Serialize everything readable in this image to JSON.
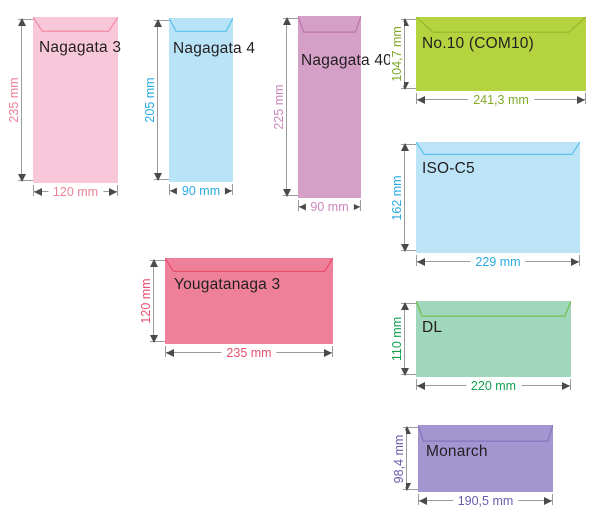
{
  "page": {
    "background": "#ffffff"
  },
  "arrow": {
    "line_color": "#9b9b9b",
    "head_color": "#4a4a4a"
  },
  "label_color": "#231f20",
  "envelopes": [
    {
      "id": "nagagata-3",
      "label": "Nagagata 3",
      "height_label": "235 mm",
      "width_label": "120 mm",
      "fill": "#f8c8da",
      "flap_line": "#f08ba4",
      "dim_color": "#ee8298",
      "orientation": "portrait"
    },
    {
      "id": "nagagata-4",
      "label": "Nagagata 4",
      "height_label": "205 mm",
      "width_label": "90 mm",
      "fill": "#b9e3f6",
      "flap_line": "#58c2ea",
      "dim_color": "#29abe2",
      "orientation": "portrait"
    },
    {
      "id": "nagagata-40",
      "label": "Nagagata 40",
      "height_label": "225 mm",
      "width_label": "90 mm",
      "fill": "#d4a0c7",
      "flap_line": "#bd72ab",
      "dim_color": "#cd86bd",
      "orientation": "portrait"
    },
    {
      "id": "no10-com10",
      "label": "No.10 (COM10)",
      "height_label": "104,7 mm",
      "width_label": "241,3 mm",
      "fill": "#b5d23f",
      "flap_line": "#96b52e",
      "dim_color": "#7fa826",
      "orientation": "landscape"
    },
    {
      "id": "iso-c5",
      "label": "ISO-C5",
      "height_label": "162 mm",
      "width_label": "229 mm",
      "fill": "#bce3f6",
      "flap_line": "#5cc3ee",
      "dim_color": "#29abe2",
      "orientation": "landscape"
    },
    {
      "id": "yougatanaga-3",
      "label": "Yougatanaga 3",
      "height_label": "120 mm",
      "width_label": "235 mm",
      "fill": "#ee8199",
      "flap_line": "#e84a68",
      "dim_color": "#e8516f",
      "orientation": "landscape"
    },
    {
      "id": "dl",
      "label": "DL",
      "height_label": "110 mm",
      "width_label": "220 mm",
      "fill": "#a0d6bb",
      "flap_line": "#6cbf47",
      "dim_color": "#14a050",
      "orientation": "landscape"
    },
    {
      "id": "monarch",
      "label": "Monarch",
      "height_label": "98,4 mm",
      "width_label": "190,5 mm",
      "fill": "#a396d0",
      "flap_line": "#8175bd",
      "dim_color": "#6a5cad",
      "orientation": "landscape"
    }
  ]
}
